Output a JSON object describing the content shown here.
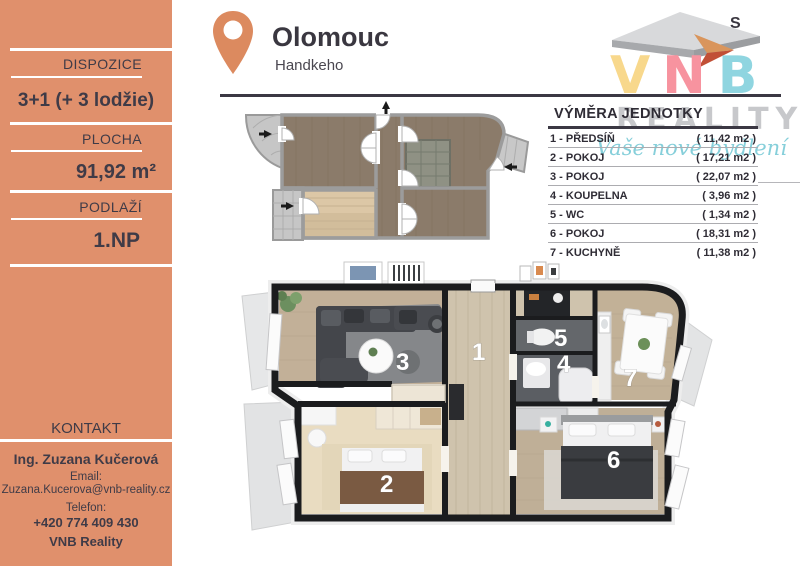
{
  "sidebar": {
    "bg_color": "#E0906C",
    "sections": [
      {
        "label": "DISPOZICE",
        "value": "3+1 (+ 3 lodžie)"
      },
      {
        "label": "PLOCHA",
        "value": "91,92 m²"
      },
      {
        "label": "PODLAŽÍ",
        "value": "1.NP"
      }
    ],
    "contact": {
      "label": "KONTAKT",
      "name": "Ing. Zuzana Kučerová",
      "email_label": "Email:",
      "email": "Zuzana.Kucerova@vnb-reality.cz",
      "phone_label": "Telefon:",
      "phone": "+420 774 409 430",
      "company": "VNB Reality"
    }
  },
  "header": {
    "city": "Olomouc",
    "street": "Handkeho",
    "pin_color": "#DC8A5F"
  },
  "logo": {
    "letters": [
      {
        "char": "V",
        "color": "#F8D88C"
      },
      {
        "char": "N",
        "color": "#F7939F"
      },
      {
        "char": "B",
        "color": "#8FD5E0"
      }
    ],
    "word": "REALITY",
    "word_color": "#C7C8CB",
    "tagline": "Vaše nové bydlení",
    "tagline_color": "#86CFDA",
    "compass_letter": "S",
    "roof_color": "#A7A9AC",
    "arrow_color": "#C14F36"
  },
  "unit_table": {
    "title": "VÝMĚRA JEDNOTKY",
    "rows": [
      {
        "name": "1 - PŘEDSÍŇ",
        "area": "( 11,42 m2 )"
      },
      {
        "name": "2 - POKOJ",
        "area": "( 17,21 m2 )"
      },
      {
        "name": "3 - POKOJ",
        "area": "( 22,07 m2 )"
      },
      {
        "name": "4 - KOUPELNA",
        "area": "( 3,96 m2 )"
      },
      {
        "name": "5 - WC",
        "area": "( 1,34 m2 )"
      },
      {
        "name": "6 - POKOJ",
        "area": "( 18,31 m2 )"
      },
      {
        "name": "7 - KUCHYNĚ",
        "area": "( 11,38 m2 )"
      }
    ]
  },
  "floorplan3d": {
    "room_numbers": [
      "1",
      "2",
      "3",
      "4",
      "5",
      "6",
      "7"
    ]
  }
}
